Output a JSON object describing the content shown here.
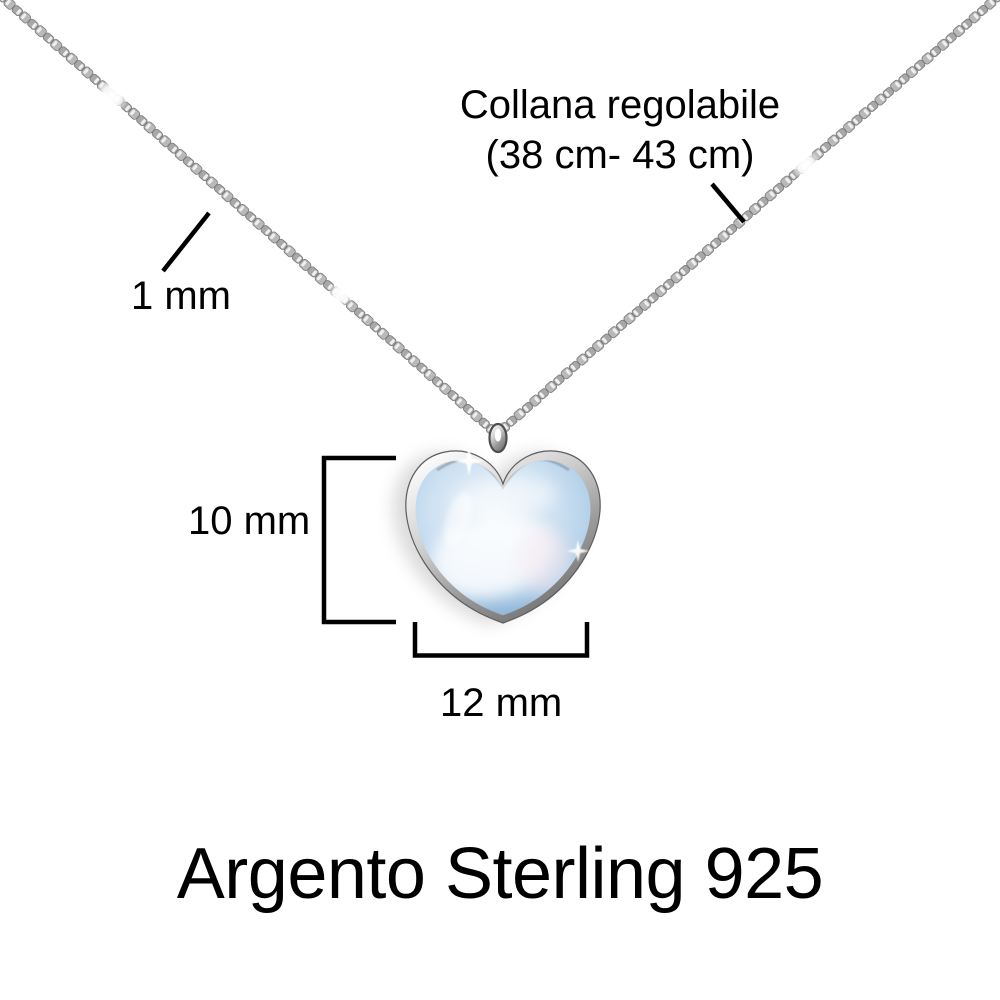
{
  "product": {
    "title": "Argento Sterling 925"
  },
  "annotations": {
    "chain_length": {
      "line1": "Collana regolabile",
      "line2": "(38 cm- 43 cm)"
    },
    "chain_thickness": "1 mm",
    "pendant_height": "10 mm",
    "pendant_width": "12 mm"
  },
  "colors": {
    "background": "#ffffff",
    "annotation_text": "#000000",
    "dimension_lines": "#000000",
    "chain_silver": "#a8a8a8",
    "chain_highlight": "#efefef",
    "bezel_silver_light": "#fdfdfd",
    "bezel_silver_dark": "#6a6a6a",
    "stone_blue_light": "#eef5fb",
    "stone_blue": "#b7d3ea",
    "stone_blue_deep": "#86afd4"
  }
}
